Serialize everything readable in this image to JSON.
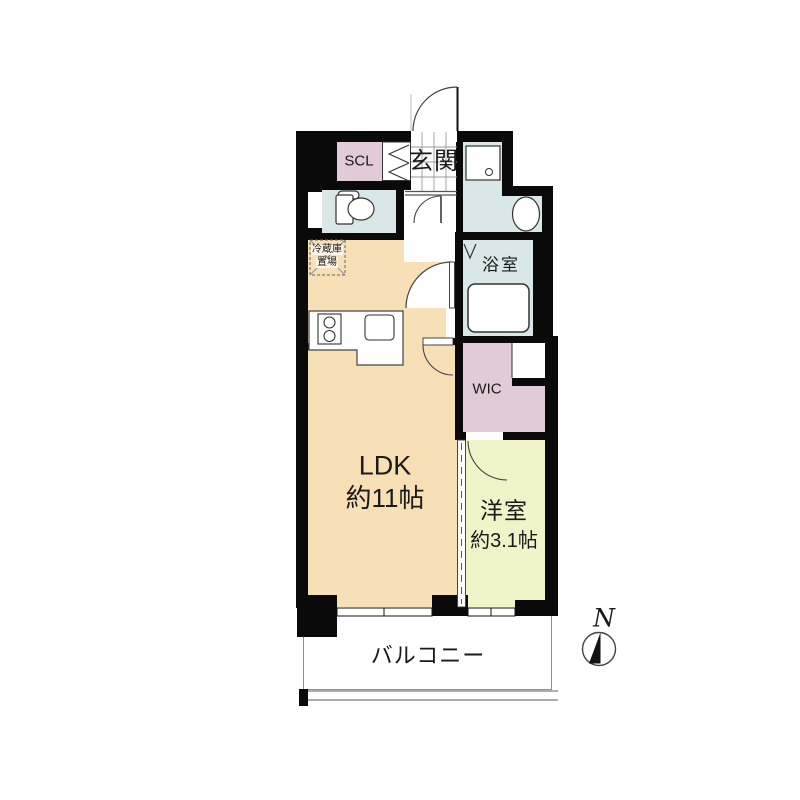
{
  "plan_type": "apartment-floor-plan",
  "rooms": {
    "entrance": {
      "label": "玄関"
    },
    "scl": {
      "label": "SCL"
    },
    "bathroom": {
      "label": "浴室"
    },
    "wic": {
      "label": "WIC"
    },
    "ldk": {
      "label": "LDK",
      "size": "約11帖"
    },
    "bedroom": {
      "label": "洋室",
      "size": "約3.1帖"
    },
    "balcony": {
      "label": "バルコニー"
    },
    "refrigerator_space": {
      "line1": "冷蔵庫",
      "line2": "置場"
    }
  },
  "compass": {
    "label": "N"
  },
  "colors": {
    "wall": "#0a0a0a",
    "ldk": "#F7DFB6",
    "wet_area": "#D9E7E8",
    "closet": "#E2CBD9",
    "bedroom": "#F1F3C9",
    "outline": "#333333",
    "balcony_line": "#909090"
  }
}
